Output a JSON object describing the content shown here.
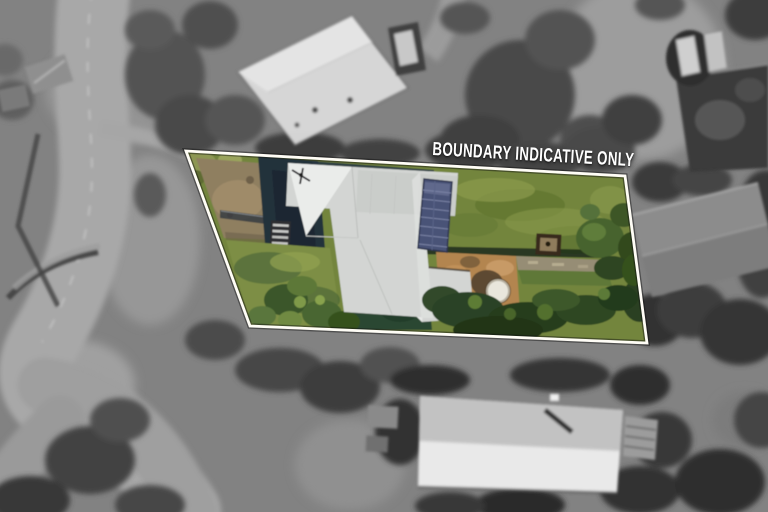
{
  "overlay": {
    "label": "BOUNDARY INDICATIVE ONLY",
    "label_color": "#ffffff",
    "boundary_color": "#fffdf6"
  },
  "palette": {
    "background_gray": "#828282",
    "lawn_green": "#73853e",
    "roof_white": "#d3d5d3",
    "solar_navy": "#4a5377",
    "brick_tan": "#b3854f",
    "dirt_brown": "#8f7f61",
    "tree_dark_green": "#2e4527",
    "neighbor_roof_white": "#d9d9d9"
  }
}
